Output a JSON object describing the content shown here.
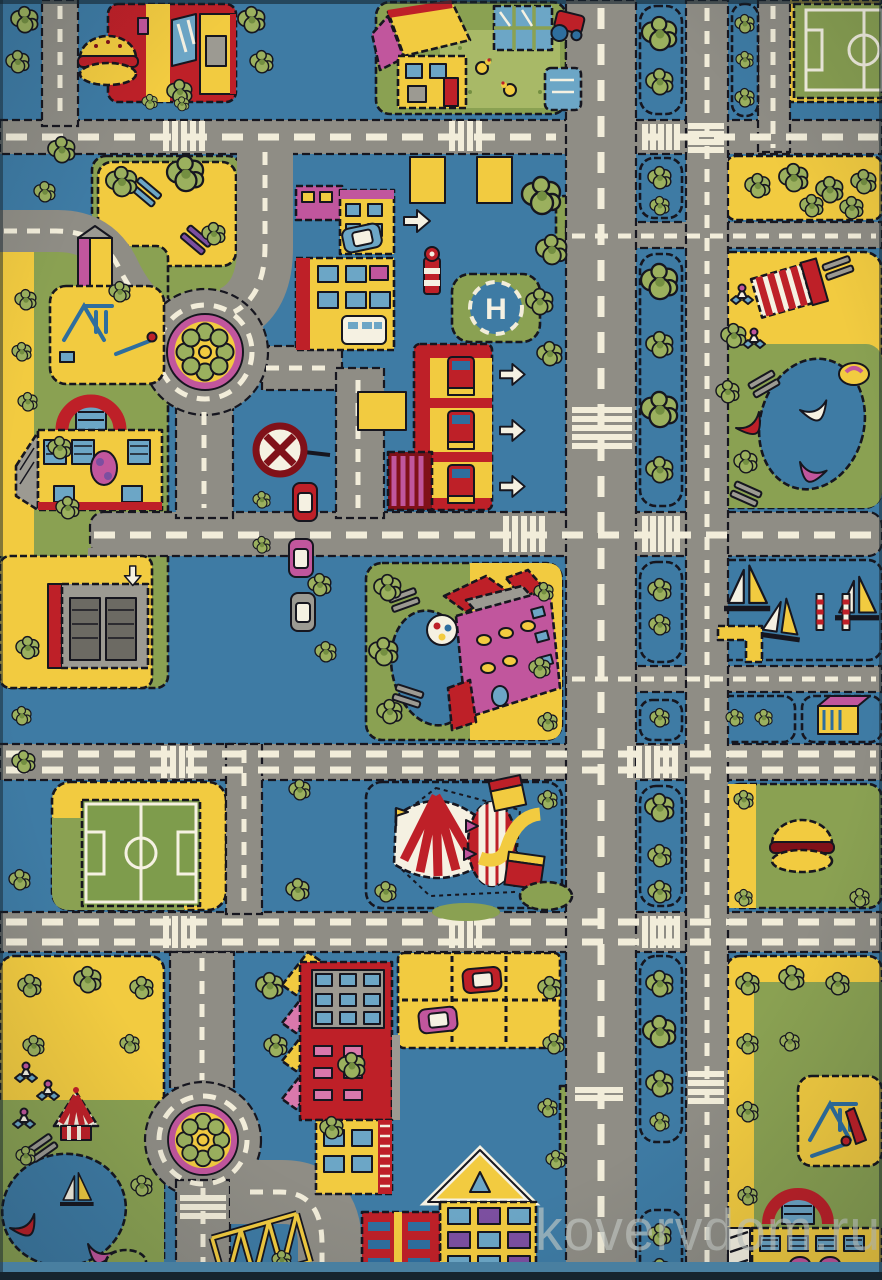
{
  "photo": {
    "subject": "children's city-roads play rug, product photo",
    "watermark": "kovervdom.ru"
  },
  "watermark": {
    "text": "kovervdom.ru"
  },
  "labels": {
    "helipad_letter": "H"
  },
  "palette": {
    "blue": "#3E7BA4",
    "road": "#8F8D85",
    "dash": "#F2EDDA",
    "outline": "#16161F",
    "yellow": "#F2CB40",
    "grass": "#8AA152",
    "tree": "#9BB05E",
    "tree_dark": "#748F41",
    "red": "#BE2028",
    "dark_red": "#801119",
    "magenta": "#C1569D",
    "pink_roof": "#D978AC",
    "purple": "#7C4FA0",
    "white": "#F5F1E2",
    "light_blue": "#6CA6C6",
    "window": "#2E6E9E",
    "gray": "#9C9A92",
    "gray_dark": "#6C6A63",
    "garden": "#A8B967",
    "field": "#7E9C4C",
    "wm": "#C9CFCA",
    "photo_edge": "#16242E",
    "rug_edge": "#497FA0"
  },
  "landmarks": [
    "burger-restaurant",
    "farmhouse-with-garden",
    "greenhouse",
    "tractor",
    "chickens",
    "soccer-field-top-right",
    "soccer-field-left",
    "roundabout-flowerbed-top",
    "roundabout-flowerbed-bottom",
    "helipad",
    "fire-station-with-trucks",
    "lighthouse-tower",
    "shops-with-parked-car",
    "school-building",
    "bus",
    "mansion-with-pond",
    "football-in-pond",
    "circus-tent",
    "marina-with-sailboats",
    "boating-lake-right",
    "boating-lake-left",
    "amusement-carousel",
    "playground-left",
    "playground-right",
    "arch-station-left",
    "arch-station-right",
    "apartment-building",
    "parking-lot-with-cars",
    "parked-cars",
    "garage-block",
    "bench-park",
    "no-entry-sign",
    "tree-lined-boulevard",
    "burger-kiosk",
    "construction-scaffold",
    "yellow-house",
    "brick-apartments",
    "crosswalks",
    "direction-arrows"
  ]
}
